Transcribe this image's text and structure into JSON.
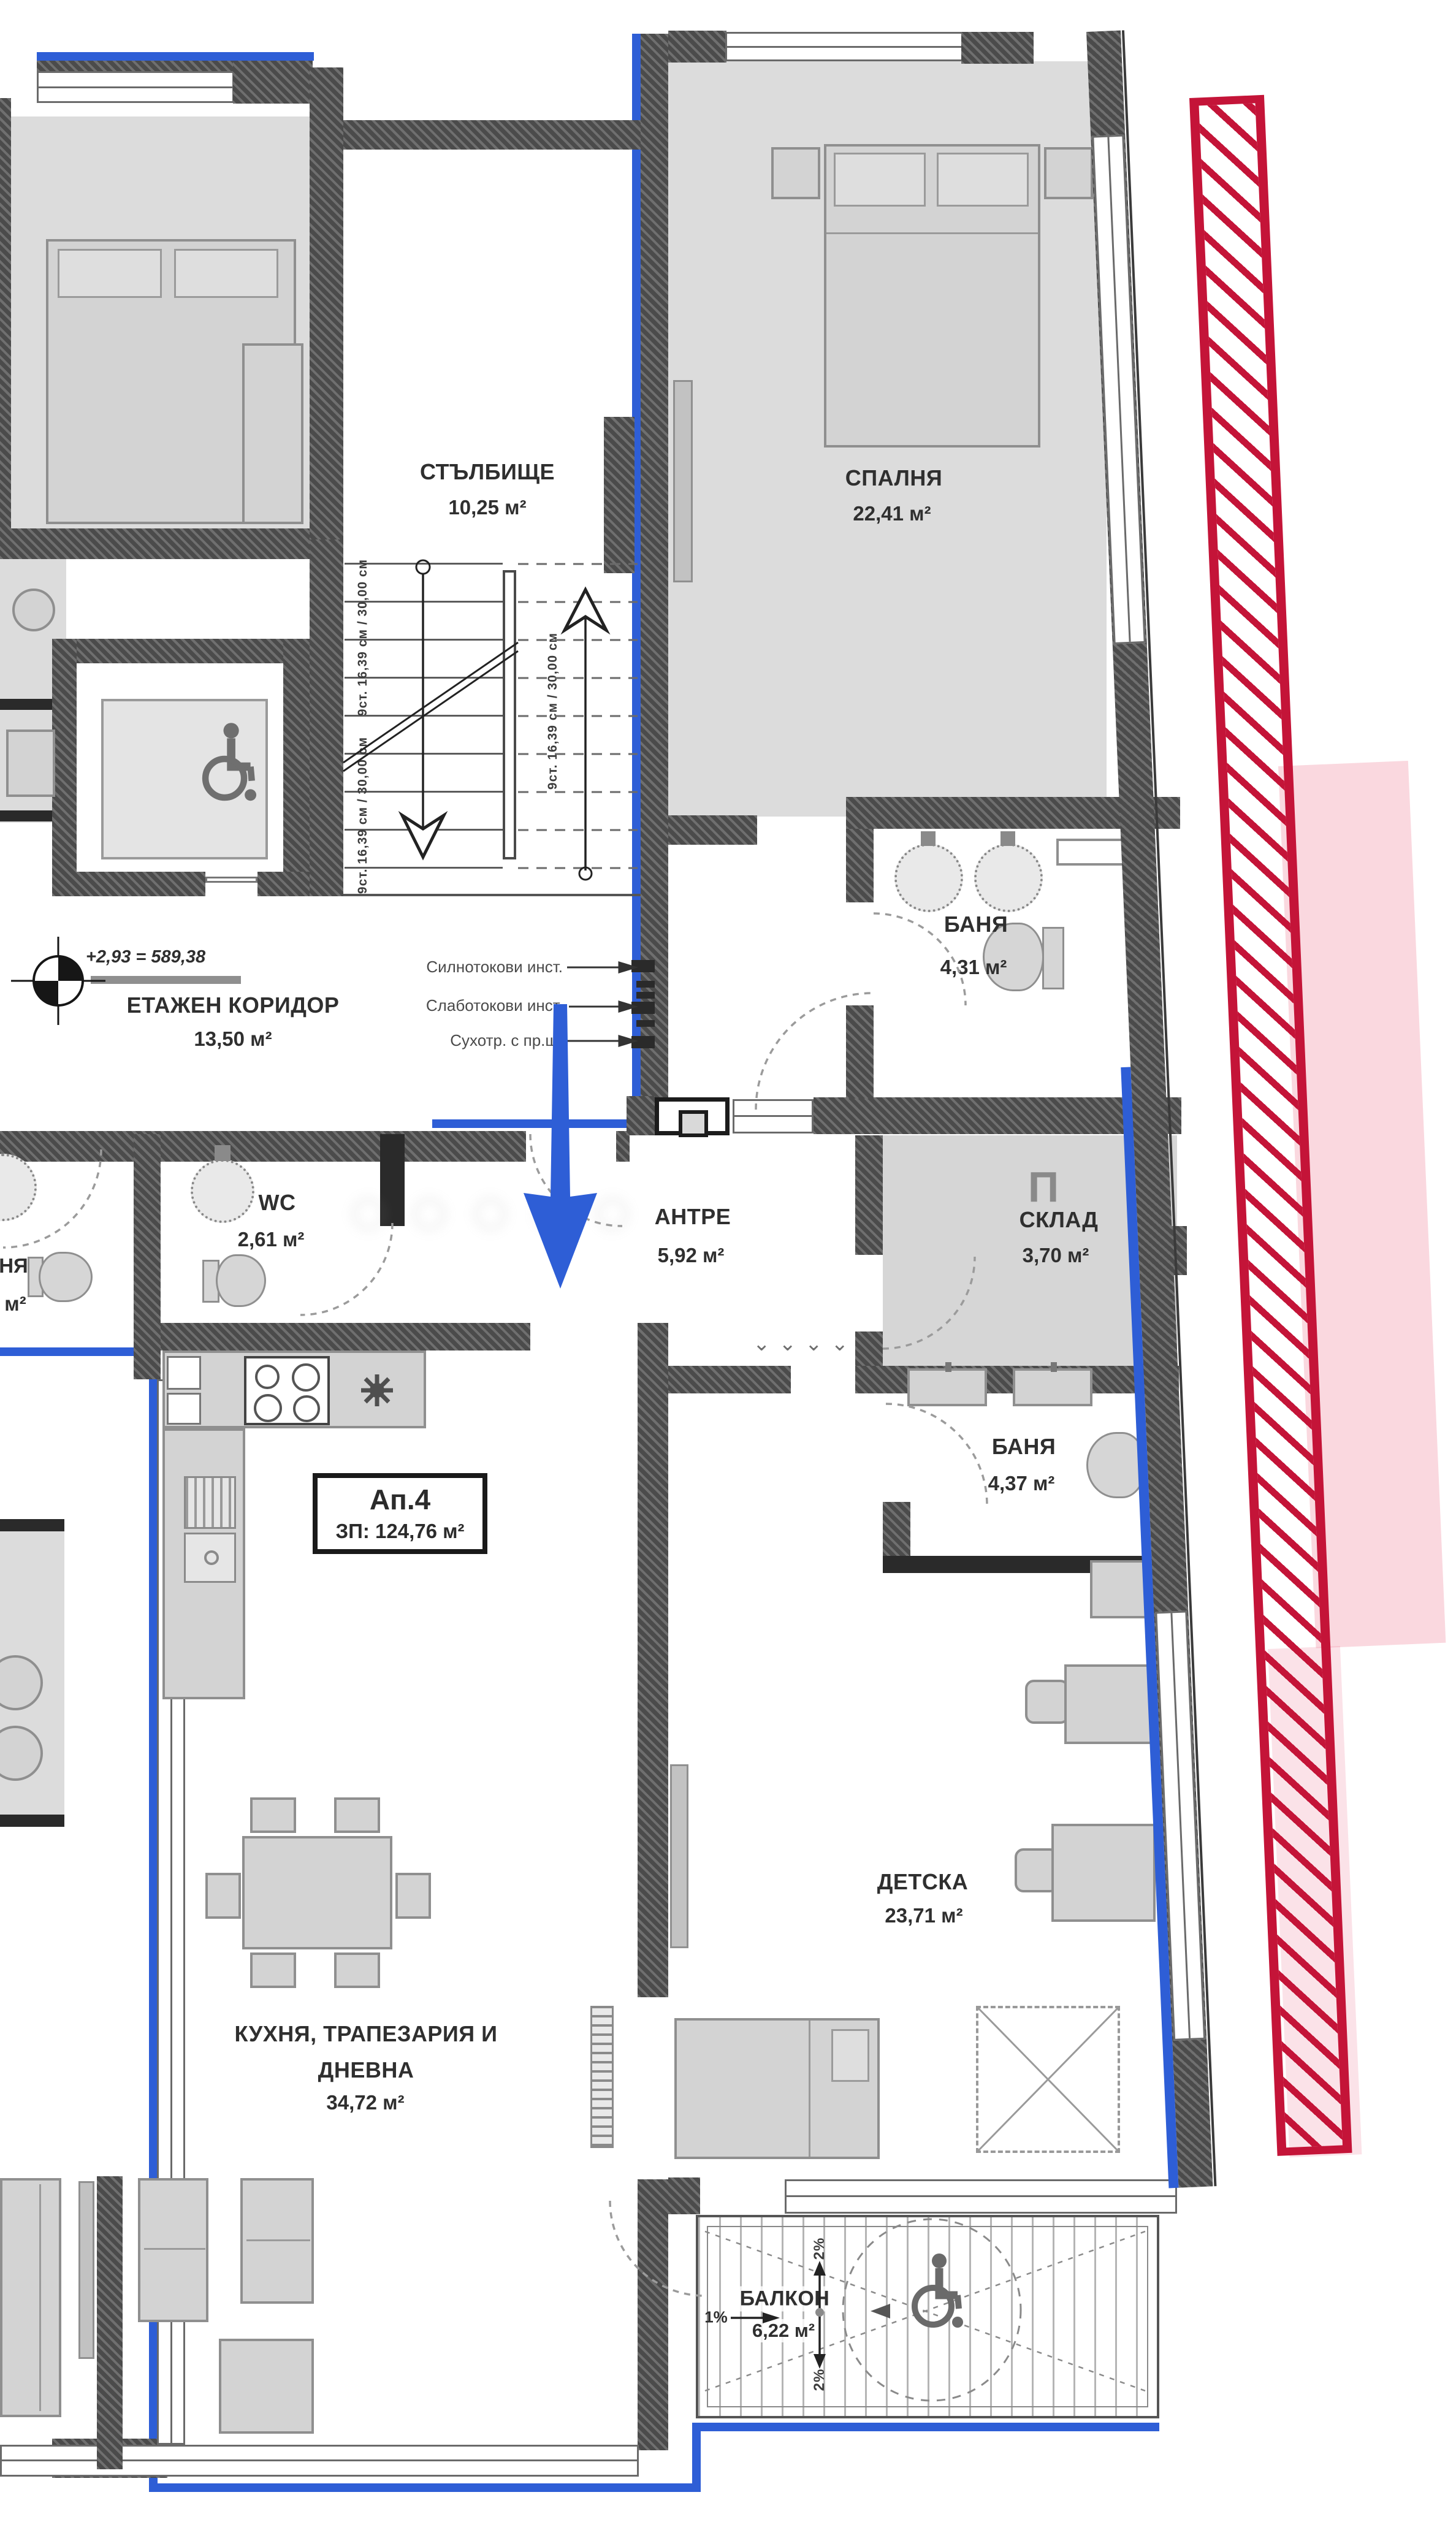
{
  "colors": {
    "insulation_blue": "#2e5ed6",
    "boundary_red": "#c41438",
    "boundary_pink": "#ef7d96",
    "wall_dark": "#4b4b4b"
  },
  "apartment_box": {
    "line1": "Ап.4",
    "line2": "ЗП: 124,76 м²"
  },
  "rooms": {
    "stairwell": {
      "name": "СТЪЛБИЩЕ",
      "area": "10,25 м²"
    },
    "floor_corridor": {
      "name": "ЕТАЖЕН КОРИДОР",
      "area": "13,50 м²"
    },
    "bedroom": {
      "name": "СПАЛНЯ",
      "area": "22,41 м²"
    },
    "bathroom_top": {
      "name": "БАНЯ",
      "area": "4,31 м²"
    },
    "wc": {
      "name": "WC",
      "area": "2,61 м²"
    },
    "entry_hall": {
      "name": "АНТРЕ",
      "area": "5,92 м²"
    },
    "storage": {
      "name": "СКЛАД",
      "area": "3,70 м²",
      "symbol": "П"
    },
    "bathroom_bottom": {
      "name": "БАНЯ",
      "area": "4,37 м²"
    },
    "kids_room": {
      "name": "ДЕТСКА",
      "area": "23,71 м²"
    },
    "kitchen_living": {
      "name_line1": "КУХНЯ, ТРАПЕЗАРИЯ И",
      "name_line2": "ДНЕВНА",
      "area": "34,72 м²"
    },
    "balcony": {
      "name": "БАЛКОН",
      "area": "6,22 м²",
      "slope_side": "1%",
      "slope_top": "2%",
      "slope_bottom": "2%"
    },
    "neighbor_room": {
      "name_fragment": "НЯ",
      "area_fragment": "м²"
    }
  },
  "annotations": {
    "elevation": "+2,93 = 589,38",
    "electrical": [
      "Силнотокови инст.",
      "Слаботокови инст.",
      "Сухотр. с пр.щ."
    ],
    "stair_flight_note": "9ст. 16,39 см / 30,00 см"
  }
}
